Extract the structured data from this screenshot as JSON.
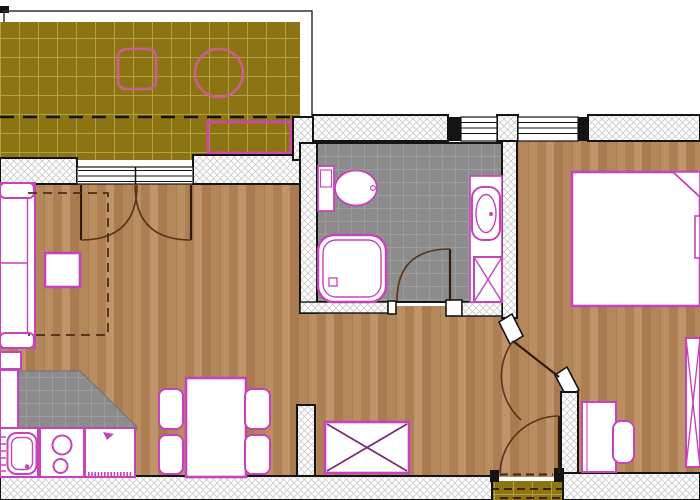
{
  "canvas": {
    "width": 700,
    "height": 500
  },
  "colors": {
    "terrace_tile": "#8d7413",
    "terrace_grid": "#d9cb82",
    "wood": "#b68a5e",
    "tile_gray": "#8c8c8c",
    "tile_line": "#9d9d9d",
    "furniture_outline": "#c743bc",
    "terrace_furniture_outline": "#c7608a",
    "wall_edge": "#141414",
    "wall_hatch_line": "#c9c9c9",
    "door_swing": "#5a3416",
    "fixture_fill": "#ffffff"
  },
  "rooms": [
    {
      "name": "terrace",
      "floor": "olive-tiles",
      "items": [
        "square-table",
        "round-table",
        "planter-box",
        "railing-outline",
        "roof-projection-dashed-line"
      ]
    },
    {
      "name": "living-room",
      "floor": "wood",
      "items": [
        "sofa",
        "sofa-bed-dashed-outline",
        "coffee-table",
        "side-table",
        "storage-chest-x"
      ]
    },
    {
      "name": "kitchen",
      "floor": "gray-tiles",
      "items": [
        "side-counter",
        "sink-unit",
        "stove-two-burners",
        "base-cabinet",
        "dining-table",
        "four-chairs"
      ]
    },
    {
      "name": "bathroom",
      "floor": "gray-tiles",
      "items": [
        "toilet-with-cistern",
        "shower-tray",
        "washbasin-counter",
        "washer-shaft-x"
      ]
    },
    {
      "name": "bedroom",
      "floor": "wood",
      "items": [
        "double-bed-with-folded-corner",
        "nightstand-cut",
        "desk",
        "desk-chair",
        "wardrobe-cut"
      ]
    },
    {
      "name": "hallway",
      "floor": "wood",
      "items": []
    },
    {
      "name": "entry-landing",
      "floor": "olive-tiles",
      "items": [
        "threshold-dashes",
        "step"
      ]
    }
  ],
  "openings": {
    "windows": [
      "terrace-french-window",
      "bathroom-window",
      "bedroom-window"
    ],
    "doors": [
      "terrace-french-doors-double-swing",
      "bathroom-door",
      "bedroom-angled-door",
      "entry-door"
    ]
  }
}
